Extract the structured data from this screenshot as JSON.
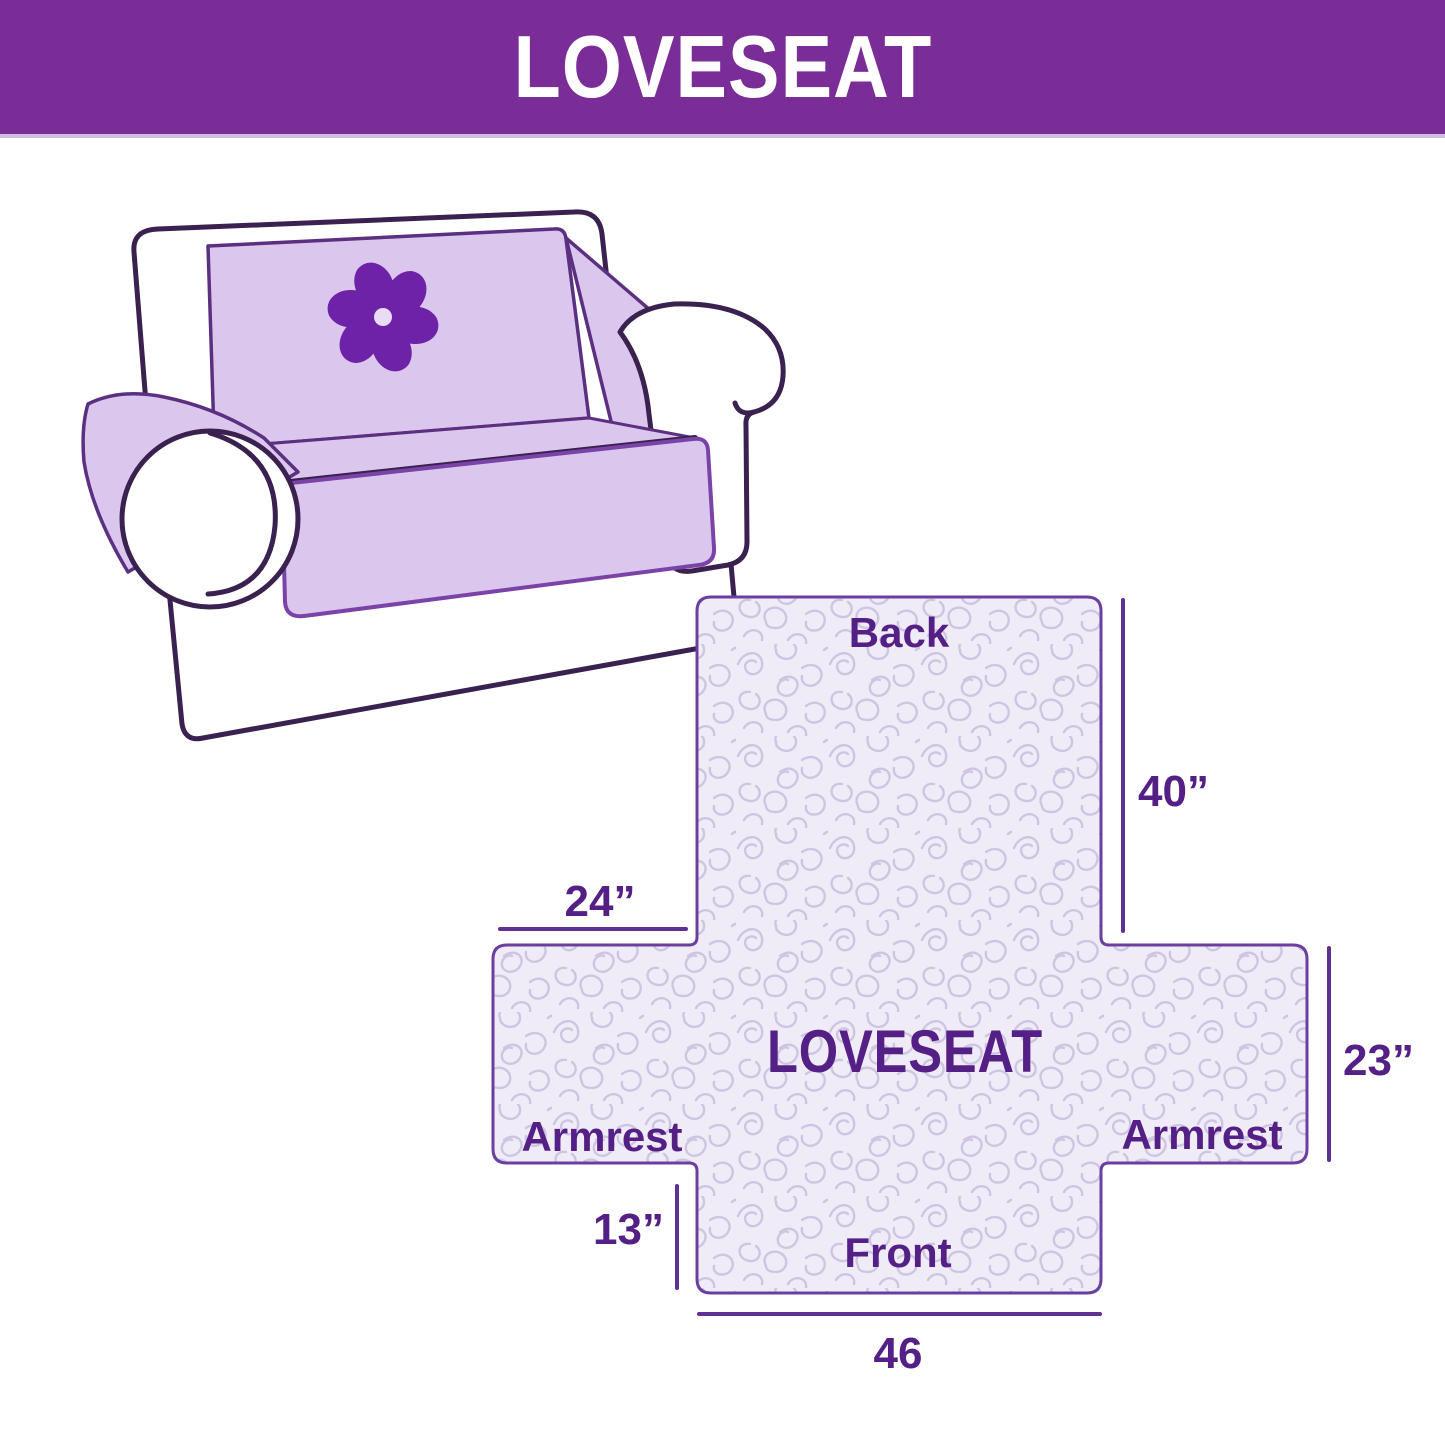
{
  "header": {
    "title": "LOVESEAT",
    "background_color": "#7A2D96",
    "text_color": "#FFFFFF"
  },
  "illustration": {
    "type": "loveseat-sofa-with-cover",
    "logo_icon": "pinwheel-icon",
    "outline_color": "#3A2150",
    "cover_color": "#DBC7EE",
    "logo_color": "#6E22A8"
  },
  "diagram": {
    "center_label": "LOVESEAT",
    "back_label": "Back",
    "front_label": "Front",
    "armrest_left_label": "Armrest",
    "armrest_right_label": "Armrest",
    "measurements": {
      "back_height": "40”",
      "armrest_top_width": "24”",
      "armrest_side_depth": "23”",
      "front_skirt_height": "13”",
      "front_bottom_width": "46"
    },
    "panel_fill_color": "#EFEBF7",
    "quilt_pattern_color": "#CFC5E2",
    "panel_border_color": "#6B3FA0",
    "label_color": "#552086",
    "measure_line_color": "#5E3192"
  }
}
